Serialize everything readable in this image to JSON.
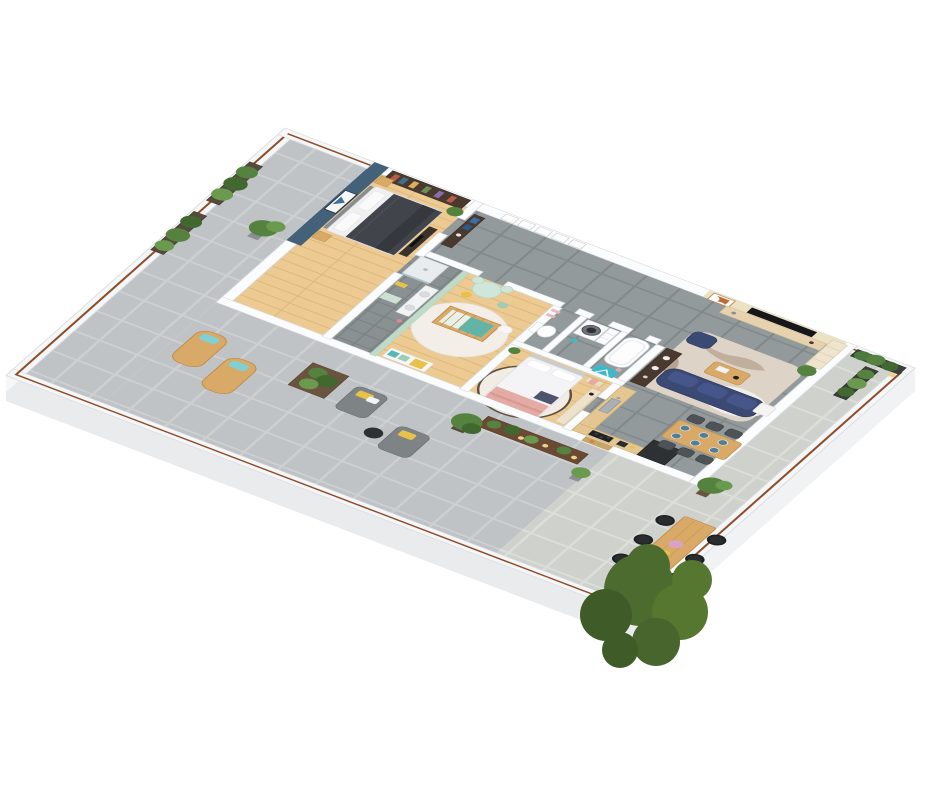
{
  "scene": {
    "type": "3d-isometric-floor-plan-render",
    "description": "Photoreal 3D floor plan of a furnished apartment with wrap-around terrace, viewed from above at an angle on a white background",
    "visible_text": "none",
    "background": "#ffffff"
  },
  "palette": {
    "background": "#ffffff",
    "slab": "#f4f5f6",
    "wall_white": "#fbfcfd",
    "slab_edge_sw": "#e9ebed",
    "slab_edge_se": "#f1f2f3",
    "slab_edge_nw": "#f6f7f8",
    "paver": "#bfc3c5",
    "paver_grout": "#cdd0d1",
    "paver_light": "#cfd2cc",
    "paver_light_grout": "#dcdeda",
    "interior_tile": "#939a9c",
    "interior_tile_grout": "#82888a",
    "ensuite_tile": "#8a9193",
    "wood_floor": "#ecca92",
    "wood_floor_line": "#d8b478",
    "accent_blue": "#44617a",
    "accent_beige": "#ebe2c4",
    "accent_mint": "#bfdac6",
    "navy": "#3b4a75",
    "navy_dark": "#303c61",
    "navy_light": "#46558a",
    "teal": "#3fb9c9",
    "teal_soft": "#58b8b0",
    "yellow": "#e8c248",
    "pink": "#e4aaa4",
    "blossom": "#d9a3c7",
    "copper_rail": "#8d4d28",
    "oak": "#d9a967",
    "oak_deep": "#c1924f",
    "walnut": "#4a392e",
    "bench_brown": "#6b4a33",
    "appliance_dark": "#2e3134",
    "cooktop_black": "#1f2225",
    "charcoal_duvet": "#41454b",
    "gray_lounge": "#7e8486",
    "rug_cream": "#ddd3c6",
    "rug_marble": "#b2a08a",
    "rug_white": "#f3efe8",
    "plant": "#55823f",
    "plant_dark": "#41692f",
    "plant_light": "#6a9a4d",
    "tree": "#4c6b2f",
    "tree_dark": "#3f5c28",
    "tree_light": "#55772f",
    "candle_glow": "#f3d08a",
    "cream_cabinet": "#ece1ca",
    "headboard_gray": "#8a8d90",
    "plate_blue": "#4f7f96"
  },
  "rooms": [
    {
      "id": "master-bedroom",
      "items": [
        "double bed with dark duvet",
        "blue accent wall",
        "wall art",
        "bookshelf",
        "nightstands",
        "low dresser with tv",
        "plant"
      ]
    },
    {
      "id": "ensuite-shower-room",
      "items": [
        "walk-in shower",
        "vanity",
        "mint accent wall",
        "yellow towel",
        "bath mat"
      ]
    },
    {
      "id": "hallway",
      "items": [
        "five picture frames",
        "dark console with blue books"
      ]
    },
    {
      "id": "nursery",
      "items": [
        "crib with teal mattress",
        "round white rug",
        "play table with chairs",
        "yellow stool",
        "changing dresser",
        "floor pillow"
      ]
    },
    {
      "id": "wc",
      "items": [
        "toilet",
        "pink wall shelves"
      ]
    },
    {
      "id": "laundry-room",
      "items": [
        "washing machine",
        "drawer unit",
        "teal basket"
      ]
    },
    {
      "id": "bathroom",
      "items": [
        "bathtub",
        "teal rug",
        "dark double-sink vanity"
      ]
    },
    {
      "id": "bedroom",
      "items": [
        "double bed with pink blanket",
        "round rug with dark rim",
        "foot bench with pink throw",
        "cream credenza",
        "black lamp",
        "plant"
      ]
    },
    {
      "id": "kitchen",
      "items": [
        "L-shaped counter",
        "sink",
        "black cooktop",
        "toaster",
        "dark fridge column",
        "serving board"
      ]
    },
    {
      "id": "dining-area",
      "items": [
        "wood dining table",
        "six dark chairs",
        "six blue place settings"
      ]
    },
    {
      "id": "living-room",
      "items": [
        "beige accent wall",
        "wall tv",
        "tv lowboard",
        "orange wall art",
        "tall shelf unit",
        "navy modular sofa",
        "navy pouf",
        "coffee table",
        "white side table",
        "cream marbled rug",
        "white fluffy rug",
        "dark sideboard",
        "corner plant"
      ]
    },
    {
      "id": "terrace-left",
      "items": [
        "two planter boxes",
        "potted palm"
      ]
    },
    {
      "id": "terrace-bottom",
      "items": [
        "two wooden chaise lounges with teal pillows",
        "planter table",
        "two gray loungers with yellow pillows",
        "black side table",
        "candle bench with potted plants",
        "large potted plant"
      ]
    },
    {
      "id": "terrace-right",
      "items": [
        "planter boxes with grasses",
        "lantern",
        "potted palm",
        "outdoor dining table",
        "six black wire chairs",
        "flower vase",
        "yellow bowl",
        "large tree at corner"
      ]
    }
  ],
  "counts": {
    "bedrooms": 3,
    "indoor_dining_chairs": 6,
    "outdoor_dining_chairs": 6,
    "chaise_lounges": 2,
    "gray_loungers": 2,
    "sofas": 1,
    "washing_machines": 1,
    "trees": 1
  }
}
